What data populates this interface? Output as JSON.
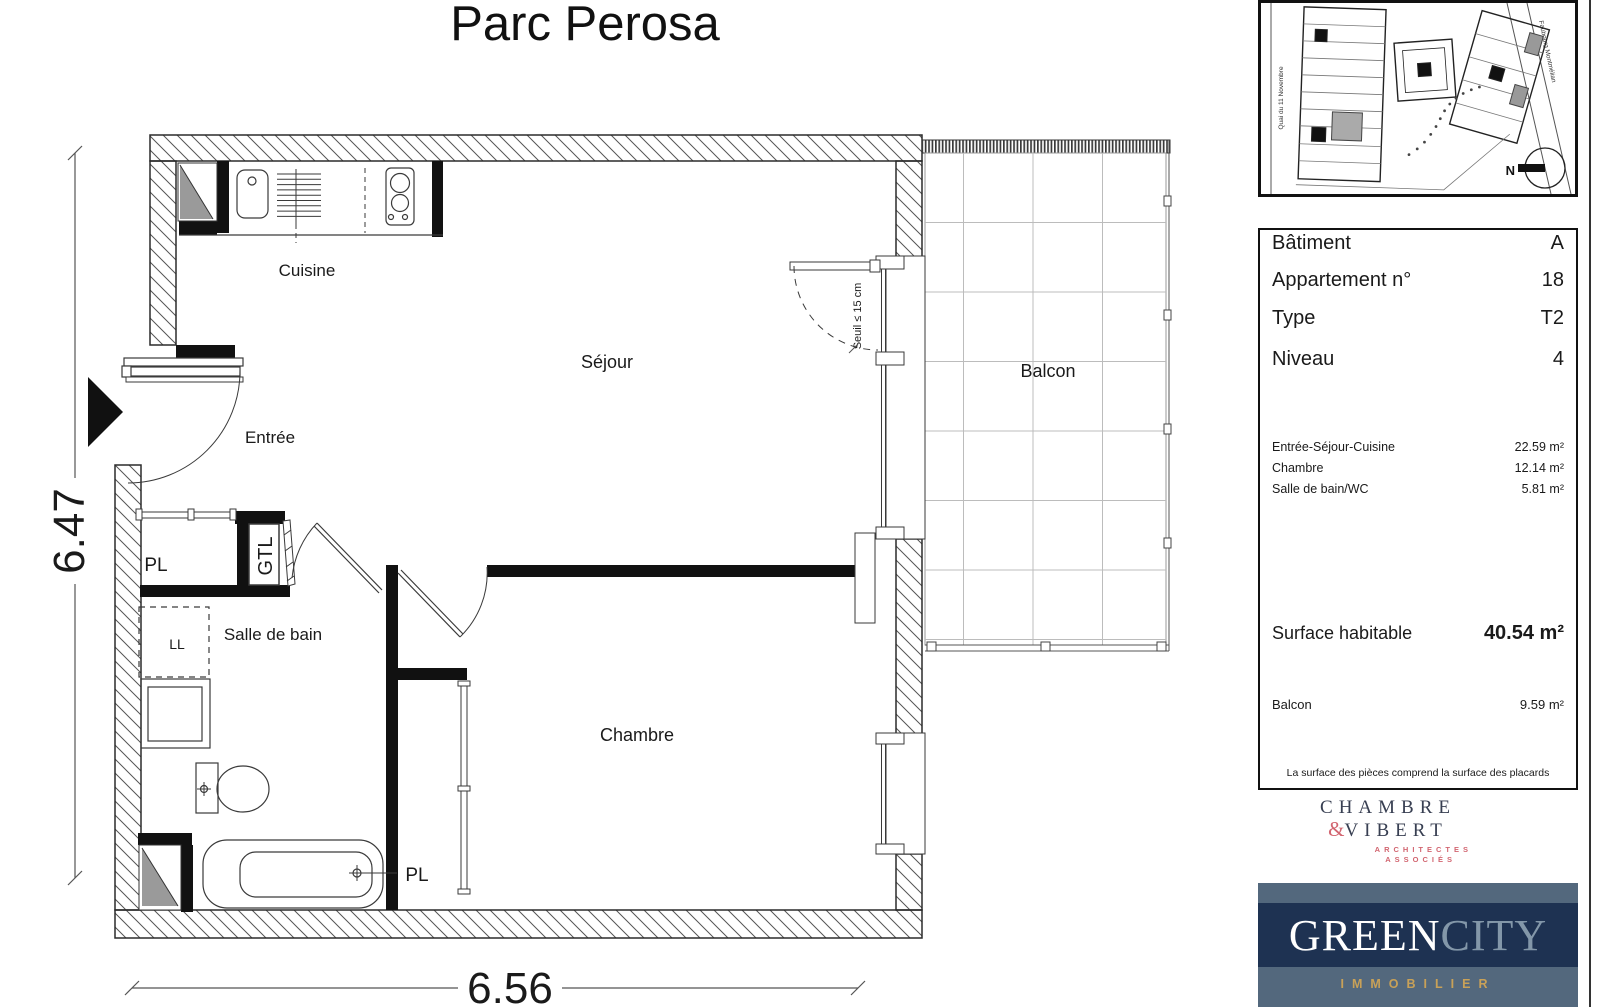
{
  "title": "Parc Perosa",
  "plan": {
    "rooms": {
      "cuisine": "Cuisine",
      "sejour": "Séjour",
      "entree": "Entrée",
      "salle_de_bain": "Salle de bain",
      "chambre": "Chambre",
      "balcon": "Balcon",
      "pl_entree": "PL",
      "pl_chambre": "PL",
      "gtl": "GTL",
      "ll": "LL"
    },
    "annotations": {
      "seuil": "Seuil ≤ 15 cm"
    },
    "dimensions": {
      "height": "6.47",
      "width": "6.56"
    }
  },
  "site": {
    "street_left": "Quai du 11 Novembre",
    "street_right": "Faubourg Montmélian",
    "north": "N"
  },
  "info_panel": {
    "rows": [
      {
        "label": "Bâtiment",
        "value": "A"
      },
      {
        "label": "Appartement n°",
        "value": "18"
      },
      {
        "label": "Type",
        "value": "T2"
      },
      {
        "label": "Niveau",
        "value": "4"
      }
    ],
    "areas": [
      {
        "label": "Entrée-Séjour-Cuisine",
        "value": "22.59 m²"
      },
      {
        "label": "Chambre",
        "value": "12.14 m²"
      },
      {
        "label": "Salle de bain/WC",
        "value": "5.81 m²"
      }
    ],
    "surface_label": "Surface habitable",
    "surface_value": "40.54 m²",
    "balcony_label": "Balcon",
    "balcony_value": "9.59 m²",
    "footnote": "La surface des pièces comprend la surface des placards"
  },
  "logos": {
    "architect": {
      "name1": "CHAMBRE",
      "amp": "&",
      "name2": "VIBERT",
      "sub1": "ARCHITECTES",
      "sub2": "ASSOCIÉS",
      "navy": "#383f52",
      "red": "#d26570"
    },
    "developer": {
      "word1": "GREEN",
      "word2": "CITY",
      "sub": "IMMOBILIER",
      "bg": "#53687d",
      "band": "#1e3252",
      "gold": "#c8a158"
    }
  }
}
